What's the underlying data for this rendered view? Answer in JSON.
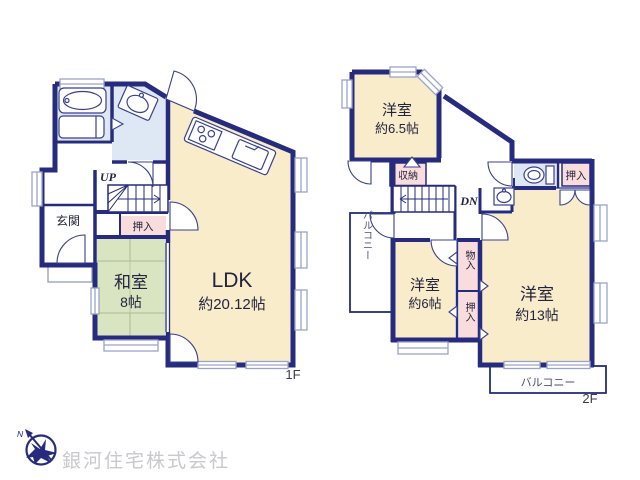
{
  "colors": {
    "wall": "#262b7e",
    "thin_line": "#3a3f8f",
    "window_line": "#9aa3c9",
    "room_cream": "#f8ecca",
    "room_green": "#d9e5c0",
    "room_pink": "#f9dcdc",
    "room_blue": "#dde8f4",
    "label_navy": "#23233f",
    "company_gray": "#c8c8cd"
  },
  "floor1": {
    "floor_label": "1F",
    "genkan": "玄関",
    "stairs_up": "UP",
    "oshiire": "押入",
    "washitsu_name": "和室",
    "washitsu_size": "8帖",
    "ldk_name": "LDK",
    "ldk_size": "約20.12帖"
  },
  "floor2": {
    "floor_label": "2F",
    "stairs_down": "DN",
    "shuno": "収納",
    "balcony_left": "バルコニー",
    "balcony_bottom": "バルコニー",
    "oshiire_topright": "押入",
    "monoire": "物入",
    "oshiire_side": "押入",
    "yoshitsu65_name": "洋室",
    "yoshitsu65_size": "約6.5帖",
    "yoshitsu6_name": "洋室",
    "yoshitsu6_size": "約6帖",
    "yoshitsu13_name": "洋室",
    "yoshitsu13_size": "約13帖"
  },
  "logo": {
    "direction": "N",
    "company": "銀河住宅株式会社"
  }
}
